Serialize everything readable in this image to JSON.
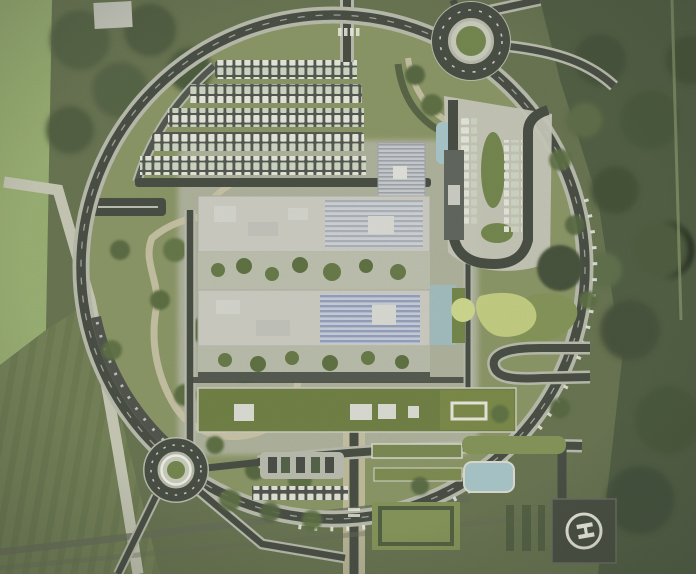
{
  "meta": {
    "title": "Aerial master-plan rendering of a circular hospital campus",
    "view": "top-down site plan"
  },
  "palette": {
    "forest": "#5f6c48",
    "forest_dark": "#47553a",
    "field": "#93aa6c",
    "interior": "#85905f",
    "campus_pad": "#b6b8ab",
    "asphalt": "#3f443c",
    "casing": "#b4b7a8",
    "tan_path": "#c8c1a4",
    "roof": "#c8c8c0",
    "solar_gray": "#a7adb6",
    "solar_blue": "#8e9ab9",
    "green_roof": "#68793c",
    "lawn": "#7d8e50",
    "water": "#a3c2c6",
    "grove_dark": "#3c4a30",
    "pad_dark": "#3f4439",
    "marking": "#eeeee6",
    "car_light": "#e4e5db"
  },
  "helipad": {
    "marking": "H"
  },
  "features": {
    "ring_road": "circular perimeter road",
    "roundabout_northeast": "roundabout, green centre island",
    "roundabout_southwest": "roundabout, green centre island",
    "parking_rows": "angled parking rows filled with cars",
    "building_north": "flat-roof block with rooftop solar array",
    "building_south": "flat-roof block with rooftop solar array",
    "green_roof_building": "long planted-roof building with skylights",
    "drop_off_loop": "eastern drop-off loop with parking strips",
    "hairpin_drive": "south-east hairpin service drive",
    "helipad": "square helipad with H marking",
    "pond": "small rectangular pond",
    "west_park": "landscaped park with looping footpaths",
    "east_forest": "dense tree belt",
    "west_field": "open field with farm track"
  }
}
